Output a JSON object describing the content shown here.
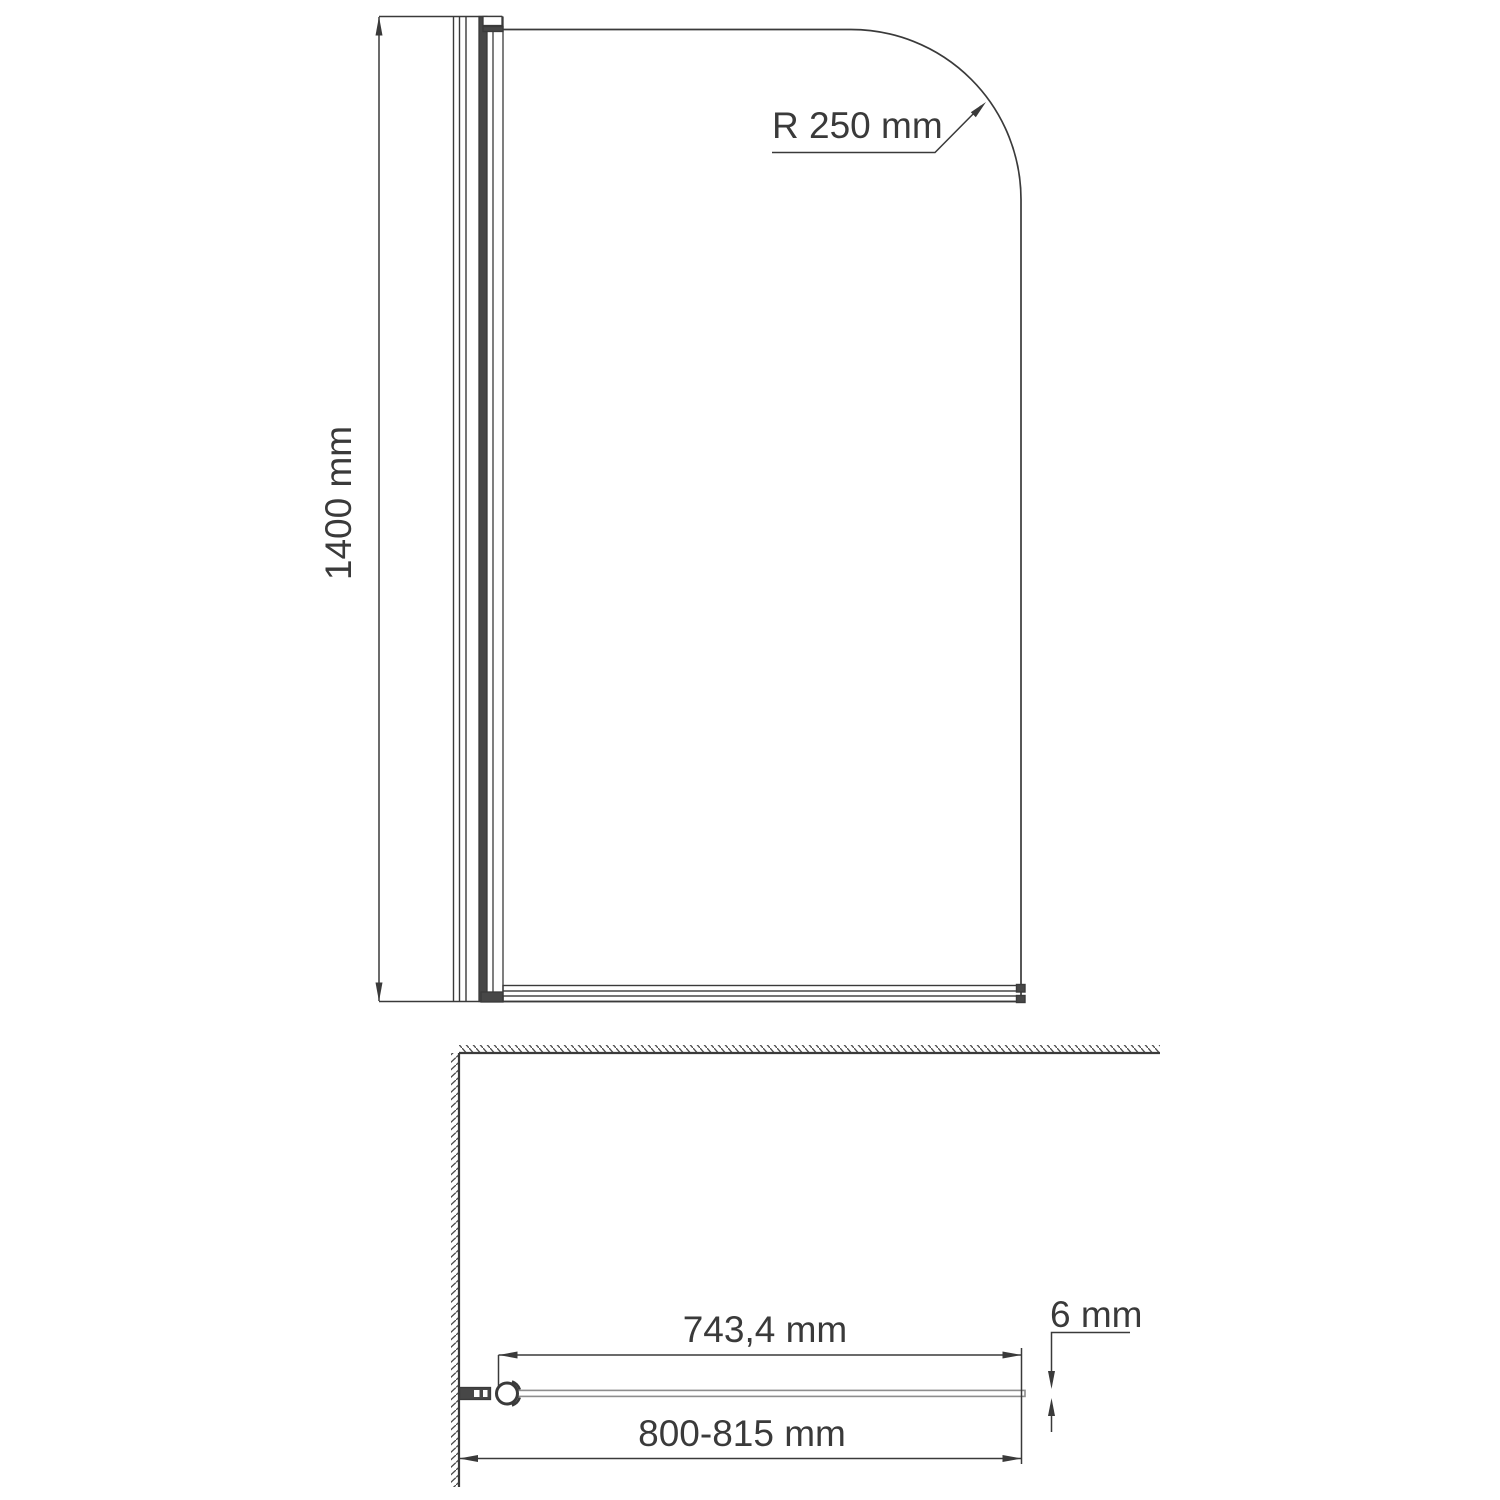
{
  "drawing": {
    "name": "Bath screen technical drawing, front view and plan view",
    "front_view": {
      "height_label": "1400 mm",
      "radius_label": "R 250 mm"
    },
    "plan_view": {
      "glass_width_label": "743,4 mm",
      "thickness_label": "6 mm",
      "overall_width_label": "800-815 mm"
    },
    "colors": {
      "line": "#3a3a3a",
      "glass_line": "#8d8d8d",
      "dark_fill": "#474747",
      "hatch": "#4a4a4a",
      "background": "#ffffff"
    }
  }
}
